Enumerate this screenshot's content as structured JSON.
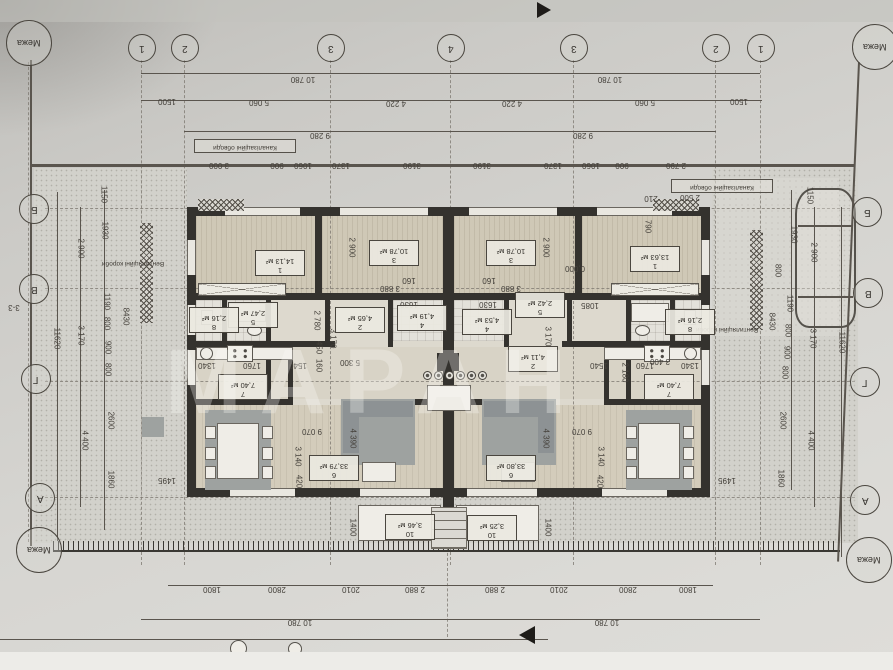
{
  "document": {
    "kind": "scanned architectural floor plan (duplex house), drawing rotated 180°",
    "watermark": "МАРАН"
  },
  "boundary": {
    "label": "Межа",
    "positions": [
      {
        "x": 28,
        "y": 42
      },
      {
        "x": 874,
        "y": 46
      },
      {
        "x": 38,
        "y": 549
      },
      {
        "x": 868,
        "y": 559
      }
    ]
  },
  "grid": {
    "top_numbers": [
      {
        "t": "1",
        "x": 141
      },
      {
        "t": "2",
        "x": 184
      },
      {
        "t": "3",
        "x": 330
      },
      {
        "t": "4",
        "x": 450
      },
      {
        "t": "3",
        "x": 573
      },
      {
        "t": "2",
        "x": 715
      },
      {
        "t": "1",
        "x": 760
      }
    ],
    "left_letters": [
      {
        "t": "Б",
        "x": 33,
        "y": 208
      },
      {
        "t": "В",
        "x": 33,
        "y": 288
      },
      {
        "t": "Г",
        "x": 35,
        "y": 378
      },
      {
        "t": "А",
        "x": 39,
        "y": 497
      }
    ],
    "right_letters": [
      {
        "t": "Б",
        "x": 866,
        "y": 211
      },
      {
        "t": "В",
        "x": 867,
        "y": 292
      },
      {
        "t": "Г",
        "x": 864,
        "y": 381
      },
      {
        "t": "А",
        "x": 864,
        "y": 499
      }
    ]
  },
  "notes": [
    {
      "t": "Каналізаційні обводи",
      "x": 242,
      "y": 144,
      "boxed": true
    },
    {
      "t": "Каналізаційні обводи",
      "x": 719,
      "y": 184,
      "boxed": true
    },
    {
      "t": "Вентиляційні короби",
      "x": 133,
      "y": 262,
      "boxed": false
    },
    {
      "t": "Вентиляційні короби",
      "x": 727,
      "y": 328,
      "boxed": false
    }
  ],
  "rooms": [
    {
      "unit": "left",
      "num": "1",
      "area": "14,13 м²",
      "x": 277,
      "y": 261
    },
    {
      "unit": "left",
      "num": "3",
      "area": "10,78 м²",
      "x": 391,
      "y": 251
    },
    {
      "unit": "left",
      "num": "2",
      "area": "4,65 м²",
      "x": 357,
      "y": 318
    },
    {
      "unit": "left",
      "num": "4",
      "area": "4,19 м²",
      "x": 419,
      "y": 316
    },
    {
      "unit": "left",
      "num": "5",
      "area": "2,47 м²",
      "x": 250,
      "y": 313
    },
    {
      "unit": "left",
      "num": "8",
      "area": "2,16 м²",
      "x": 211,
      "y": 318
    },
    {
      "unit": "left",
      "num": "7",
      "area": "7,40 м²",
      "x": 240,
      "y": 385
    },
    {
      "unit": "left",
      "num": "6",
      "area": "33,79 м²",
      "x": 331,
      "y": 466
    },
    {
      "unit": "left",
      "num": "10",
      "area": "3,46 м²",
      "x": 407,
      "y": 525
    },
    {
      "unit": "right",
      "num": "1",
      "area": "13,63 м²",
      "x": 652,
      "y": 257
    },
    {
      "unit": "right",
      "num": "3",
      "area": "10,78 м²",
      "x": 508,
      "y": 251
    },
    {
      "unit": "right",
      "num": "4",
      "area": "4,53 м²",
      "x": 484,
      "y": 320
    },
    {
      "unit": "right",
      "num": "5",
      "area": "2,42 м²",
      "x": 537,
      "y": 303
    },
    {
      "unit": "right",
      "num": "2",
      "area": "4,11 м²",
      "x": 530,
      "y": 357
    },
    {
      "unit": "right",
      "num": "8",
      "area": "2,16 м²",
      "x": 687,
      "y": 320
    },
    {
      "unit": "right",
      "num": "7",
      "area": "7,40 м²",
      "x": 666,
      "y": 385
    },
    {
      "unit": "right",
      "num": "6",
      "area": "33,80 м²",
      "x": 508,
      "y": 466
    },
    {
      "unit": "right",
      "num": "10",
      "area": "3,25 м²",
      "x": 489,
      "y": 526
    }
  ],
  "dim_labels": [
    {
      "t": "10 780",
      "x": 303,
      "y": 78
    },
    {
      "t": "10 780",
      "x": 610,
      "y": 78
    },
    {
      "t": "1500",
      "x": 167,
      "y": 100
    },
    {
      "t": "5 060",
      "x": 259,
      "y": 101
    },
    {
      "t": "4 220",
      "x": 396,
      "y": 102
    },
    {
      "t": "4 220",
      "x": 512,
      "y": 102
    },
    {
      "t": "5 060",
      "x": 645,
      "y": 101
    },
    {
      "t": "1500",
      "x": 739,
      "y": 100
    },
    {
      "t": "9 280",
      "x": 320,
      "y": 134
    },
    {
      "t": "9 280",
      "x": 583,
      "y": 134
    },
    {
      "t": "3 000",
      "x": 219,
      "y": 164
    },
    {
      "t": "900",
      "x": 277,
      "y": 164
    },
    {
      "t": "1060",
      "x": 303,
      "y": 164
    },
    {
      "t": "1370",
      "x": 341,
      "y": 164
    },
    {
      "t": "3190",
      "x": 412,
      "y": 164
    },
    {
      "t": "3190",
      "x": 482,
      "y": 164
    },
    {
      "t": "1370",
      "x": 553,
      "y": 164
    },
    {
      "t": "1060",
      "x": 591,
      "y": 164
    },
    {
      "t": "900",
      "x": 622,
      "y": 164
    },
    {
      "t": "2 790",
      "x": 676,
      "y": 164
    },
    {
      "t": "2 500",
      "x": 690,
      "y": 196
    },
    {
      "t": "210",
      "x": 651,
      "y": 197
    },
    {
      "t": "790",
      "x": 647,
      "y": 226,
      "r": "v"
    },
    {
      "t": "11620",
      "x": 56,
      "y": 338,
      "r": "v"
    },
    {
      "t": "2 900",
      "x": 80,
      "y": 248,
      "r": "v"
    },
    {
      "t": "3 170",
      "x": 80,
      "y": 335,
      "r": "v"
    },
    {
      "t": "4 400",
      "x": 84,
      "y": 440,
      "r": "v"
    },
    {
      "t": "1150",
      "x": 103,
      "y": 194,
      "r": "v"
    },
    {
      "t": "1930",
      "x": 104,
      "y": 230,
      "r": "v"
    },
    {
      "t": "1190",
      "x": 106,
      "y": 301,
      "r": "v"
    },
    {
      "t": "800",
      "x": 106,
      "y": 323,
      "r": "v"
    },
    {
      "t": "900",
      "x": 107,
      "y": 347,
      "r": "v"
    },
    {
      "t": "800",
      "x": 107,
      "y": 369,
      "r": "v"
    },
    {
      "t": "2600",
      "x": 110,
      "y": 420,
      "r": "v"
    },
    {
      "t": "1860",
      "x": 110,
      "y": 479,
      "r": "v"
    },
    {
      "t": "8430",
      "x": 125,
      "y": 316,
      "r": "v"
    },
    {
      "t": "1495",
      "x": 167,
      "y": 479
    },
    {
      "t": "11620",
      "x": 841,
      "y": 342,
      "r": "v"
    },
    {
      "t": "2 900",
      "x": 813,
      "y": 252,
      "r": "v"
    },
    {
      "t": "3 170",
      "x": 812,
      "y": 338,
      "r": "v"
    },
    {
      "t": "4 400",
      "x": 810,
      "y": 440,
      "r": "v"
    },
    {
      "t": "1150",
      "x": 809,
      "y": 195,
      "r": "v"
    },
    {
      "t": "1930",
      "x": 793,
      "y": 234,
      "r": "v"
    },
    {
      "t": "800",
      "x": 777,
      "y": 270,
      "r": "v"
    },
    {
      "t": "1190",
      "x": 789,
      "y": 303,
      "r": "v"
    },
    {
      "t": "800",
      "x": 787,
      "y": 330,
      "r": "v"
    },
    {
      "t": "900",
      "x": 786,
      "y": 352,
      "r": "v"
    },
    {
      "t": "800",
      "x": 784,
      "y": 372,
      "r": "v"
    },
    {
      "t": "2600",
      "x": 782,
      "y": 420,
      "r": "v"
    },
    {
      "t": "1860",
      "x": 780,
      "y": 478,
      "r": "v"
    },
    {
      "t": "8430",
      "x": 771,
      "y": 321,
      "r": "v"
    },
    {
      "t": "1495",
      "x": 727,
      "y": 479
    },
    {
      "t": "2 900",
      "x": 351,
      "y": 247,
      "r": "v"
    },
    {
      "t": "2 900",
      "x": 545,
      "y": 247,
      "r": "v"
    },
    {
      "t": "3 880",
      "x": 390,
      "y": 287
    },
    {
      "t": "3 880",
      "x": 511,
      "y": 287
    },
    {
      "t": "160",
      "x": 409,
      "y": 279
    },
    {
      "t": "160",
      "x": 489,
      "y": 279
    },
    {
      "t": "1630",
      "x": 409,
      "y": 303
    },
    {
      "t": "1630",
      "x": 488,
      "y": 303
    },
    {
      "t": "1085",
      "x": 590,
      "y": 304
    },
    {
      "t": "2 780",
      "x": 316,
      "y": 320,
      "r": "v"
    },
    {
      "t": "450",
      "x": 318,
      "y": 347,
      "r": "v"
    },
    {
      "t": "160",
      "x": 318,
      "y": 365,
      "r": "v"
    },
    {
      "t": "3 170",
      "x": 332,
      "y": 338,
      "r": "v"
    },
    {
      "t": "3 170",
      "x": 547,
      "y": 336,
      "r": "v"
    },
    {
      "t": "5 300",
      "x": 350,
      "y": 361
    },
    {
      "t": "3 400",
      "x": 660,
      "y": 360
    },
    {
      "t": "2 180",
      "x": 624,
      "y": 372,
      "r": "v"
    },
    {
      "t": "1340",
      "x": 207,
      "y": 364
    },
    {
      "t": "1760",
      "x": 252,
      "y": 364
    },
    {
      "t": "1540",
      "x": 298,
      "y": 364
    },
    {
      "t": "1540",
      "x": 599,
      "y": 364
    },
    {
      "t": "1760",
      "x": 645,
      "y": 364
    },
    {
      "t": "1340",
      "x": 690,
      "y": 364
    },
    {
      "t": "9 070",
      "x": 312,
      "y": 430
    },
    {
      "t": "9 070",
      "x": 582,
      "y": 430
    },
    {
      "t": "4 390",
      "x": 352,
      "y": 438,
      "r": "v"
    },
    {
      "t": "4 390",
      "x": 545,
      "y": 438,
      "r": "v"
    },
    {
      "t": "3 140",
      "x": 297,
      "y": 456,
      "r": "v"
    },
    {
      "t": "3 140",
      "x": 600,
      "y": 456,
      "r": "v"
    },
    {
      "t": "420",
      "x": 298,
      "y": 481,
      "r": "v"
    },
    {
      "t": "420",
      "x": 599,
      "y": 481,
      "r": "v"
    },
    {
      "t": "0,000",
      "x": 575,
      "y": 267
    },
    {
      "t": "1400",
      "x": 352,
      "y": 527,
      "r": "v"
    },
    {
      "t": "1400",
      "x": 547,
      "y": 527,
      "r": "v"
    },
    {
      "t": "1800",
      "x": 212,
      "y": 588
    },
    {
      "t": "2800",
      "x": 277,
      "y": 588
    },
    {
      "t": "2010",
      "x": 351,
      "y": 588
    },
    {
      "t": "2 880",
      "x": 415,
      "y": 588
    },
    {
      "t": "2 880",
      "x": 495,
      "y": 588
    },
    {
      "t": "2010",
      "x": 559,
      "y": 588
    },
    {
      "t": "2800",
      "x": 628,
      "y": 588
    },
    {
      "t": "1800",
      "x": 688,
      "y": 588
    },
    {
      "t": "10 780",
      "x": 300,
      "y": 621
    },
    {
      "t": "10 780",
      "x": 607,
      "y": 621
    },
    {
      "t": "3-3",
      "x": 14,
      "y": 306
    }
  ]
}
